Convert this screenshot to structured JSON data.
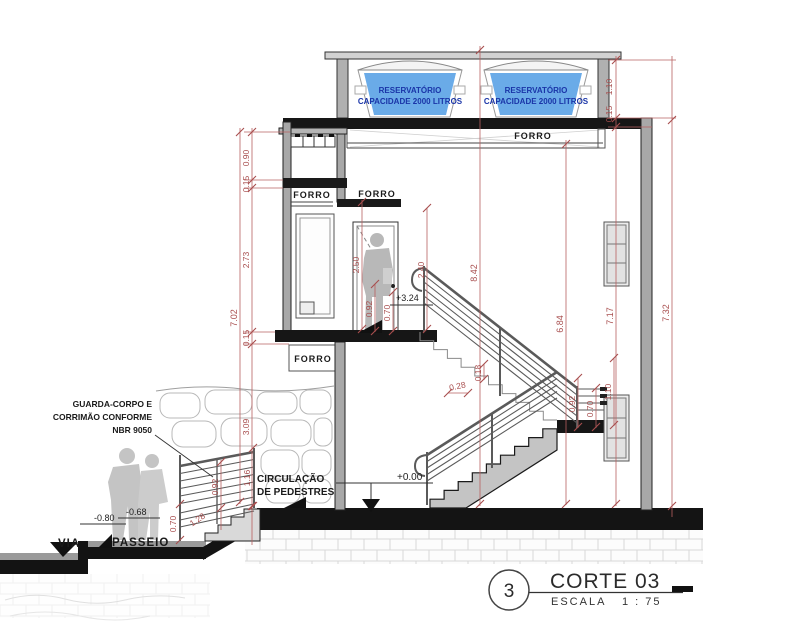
{
  "drawing": {
    "title_block": {
      "number": "3",
      "name": "CORTE 03",
      "scale_label": "ESCALA",
      "scale_value": "1 : 75"
    },
    "tanks": {
      "line1": "RESERVATÓRIO",
      "line2": "CAPACIDADE 2000 LITROS"
    },
    "labels": {
      "forro": "FORRO",
      "via": "VIA",
      "passeio": "PASSEIO",
      "guardrail_note": [
        "GUARDA-CORPO E",
        "CORRIMÃO CONFORME",
        "NBR 9050"
      ],
      "circulation": [
        "CIRCULAÇÃO",
        "DE PEDESTRES"
      ]
    },
    "levels": {
      "upper_floor": "+3.24",
      "ground_floor": "+0.00",
      "street": "-0.80",
      "sidewalk": "-0.68"
    },
    "dimensions": {
      "tower_roof_to_beam": "0.90",
      "tower_beam": "0.15",
      "tower_floor_height": "2.73",
      "upper_slab": "0.15",
      "tower_total": "7.02",
      "ground_storey": "3.09",
      "entry_rail_height": "1.16",
      "entry_rail_mid": "0.92",
      "entry_rail_low": "0.70",
      "entry_steps_run": "1.28",
      "door_height": "2.50",
      "landing_guard_high": "0.92",
      "landing_guard_low": "0.70",
      "door_head_to_floor": "2.40",
      "overall_inner_height": "8.42",
      "stair_tread": "0.28",
      "stair_riser": "0.18",
      "hall_height": "6.84",
      "stair_guard_high": "0.92",
      "stair_guard_low": "0.70",
      "landing_window": "1.10",
      "right_inner_height": "7.17",
      "right_outer_height": "7.32",
      "reservoir_room_height": "1.10",
      "roof_slab": "0.15"
    },
    "colors": {
      "dimension_red": "#a84e4e",
      "water_blue": "#6aabe8",
      "reservoir_text_navy": "#1a35a8",
      "wall_gray": "#a8a8a8",
      "slab_black": "#161616"
    }
  }
}
